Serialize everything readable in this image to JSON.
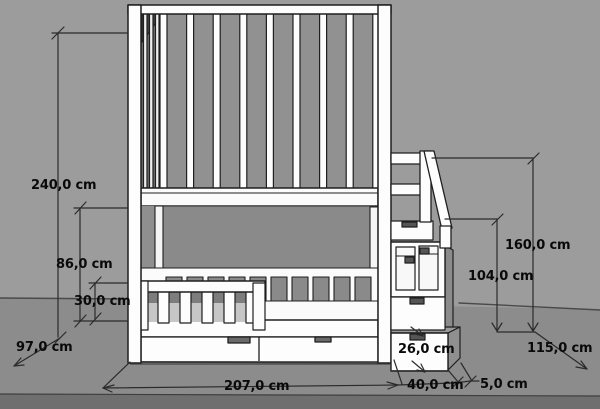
{
  "drawing": {
    "subject": "bunk bed with stair drawers",
    "unit": "cm"
  },
  "dimensions": {
    "total_height": {
      "label": "240,0 cm",
      "value": 240.0
    },
    "bunk_clearance": {
      "label": "86,0 cm",
      "value": 86.0
    },
    "guardrail_height": {
      "label": "30,0 cm",
      "value": 30.0
    },
    "bed_depth": {
      "label": "97,0 cm",
      "value": 97.0
    },
    "bed_length": {
      "label": "207,0 cm",
      "value": 207.0
    },
    "step_height": {
      "label": "26,0 cm",
      "value": 26.0
    },
    "step_depth": {
      "label": "40,0 cm",
      "value": 40.0
    },
    "side_offset": {
      "label": "5,0 cm",
      "value": 5.0
    },
    "stair_unit_height": {
      "label": "104,0 cm",
      "value": 104.0
    },
    "handrail_height": {
      "label": "160,0 cm",
      "value": 160.0
    },
    "total_depth": {
      "label": "115,0 cm",
      "value": 115.0
    }
  },
  "colors": {
    "wall": "#9c9c9c",
    "floor": "#8c8c8c",
    "floor_front_edge": "#6f6f6f",
    "furniture_face": "#fdfdfd",
    "shadow_interior": "#8a8a8a",
    "outline": "#1f1f1f",
    "dimension_line": "#2b2b2b",
    "label_text": "#0a0a0a"
  }
}
